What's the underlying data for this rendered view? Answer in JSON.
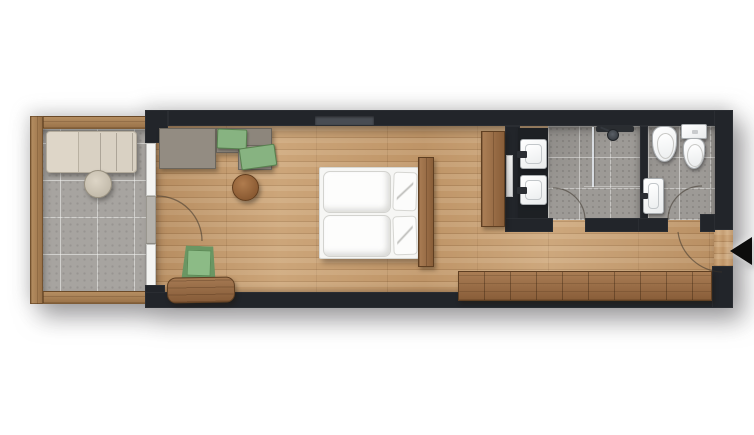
{
  "floorplan": {
    "description": "top-down floor plan of an elongated hotel room with balcony, living-bedroom, bathroom and WC",
    "colors": {
      "background": "#ffffff",
      "wall": "#22252a",
      "wood_floor": "#c49a6c",
      "balcony_tile": "#a7a4a0",
      "bathroom_tile": "#9d9a96",
      "deck_wood": "#a87f52",
      "furniture_wood": "#9b6c44",
      "sofa_gray": "#8f887e",
      "accent_green": "#87b381",
      "lounger_beige": "#d9d1c3",
      "fixture_white": "#fafaf8",
      "glass_front": "#f4f4f2",
      "entry_arrow": "#0c0c0c"
    },
    "rooms": [
      {
        "name": "balcony",
        "floor": "stone-tiles",
        "border": "wood-deck-frame"
      },
      {
        "name": "living-bedroom",
        "floor": "wood-planks"
      },
      {
        "name": "bathroom",
        "floor": "stone-tiles"
      },
      {
        "name": "wc",
        "floor": "stone-tiles"
      },
      {
        "name": "hallway",
        "floor": "wood-planks"
      }
    ],
    "items": [
      {
        "label": "Sun lounger",
        "room": "balcony"
      },
      {
        "label": "Round side table",
        "room": "balcony"
      },
      {
        "label": "Sofa with green cushions",
        "room": "living-bedroom"
      },
      {
        "label": "Round stool",
        "room": "living-bedroom"
      },
      {
        "label": "Double bed with two duvets and pillows",
        "room": "living-bedroom"
      },
      {
        "label": "Wooden headboard panel",
        "room": "living-bedroom"
      },
      {
        "label": "Wooden wardrobe panel",
        "room": "living-bedroom"
      },
      {
        "label": "Green armchair",
        "room": "living-bedroom"
      },
      {
        "label": "Wooden bench",
        "room": "living-bedroom"
      },
      {
        "label": "Long wooden sideboard",
        "room": "hallway"
      },
      {
        "label": "Washbasin 1",
        "room": "bathroom"
      },
      {
        "label": "Washbasin 2",
        "room": "bathroom"
      },
      {
        "label": "Walk-in shower",
        "room": "bathroom"
      },
      {
        "label": "Bidet",
        "room": "wc"
      },
      {
        "label": "Toilet",
        "room": "wc"
      },
      {
        "label": "Washbasin",
        "room": "wc"
      },
      {
        "label": "Mirror",
        "room": "bathroom"
      }
    ],
    "entrance": {
      "marker": "left-pointing-arrow",
      "side": "right"
    },
    "doors": [
      {
        "name": "balcony-door",
        "swing": "quarter-arc"
      },
      {
        "name": "bathroom-door",
        "swing": "quarter-arc"
      },
      {
        "name": "wc-door",
        "swing": "quarter-arc"
      },
      {
        "name": "entry-door",
        "swing": "quarter-arc"
      }
    ]
  }
}
